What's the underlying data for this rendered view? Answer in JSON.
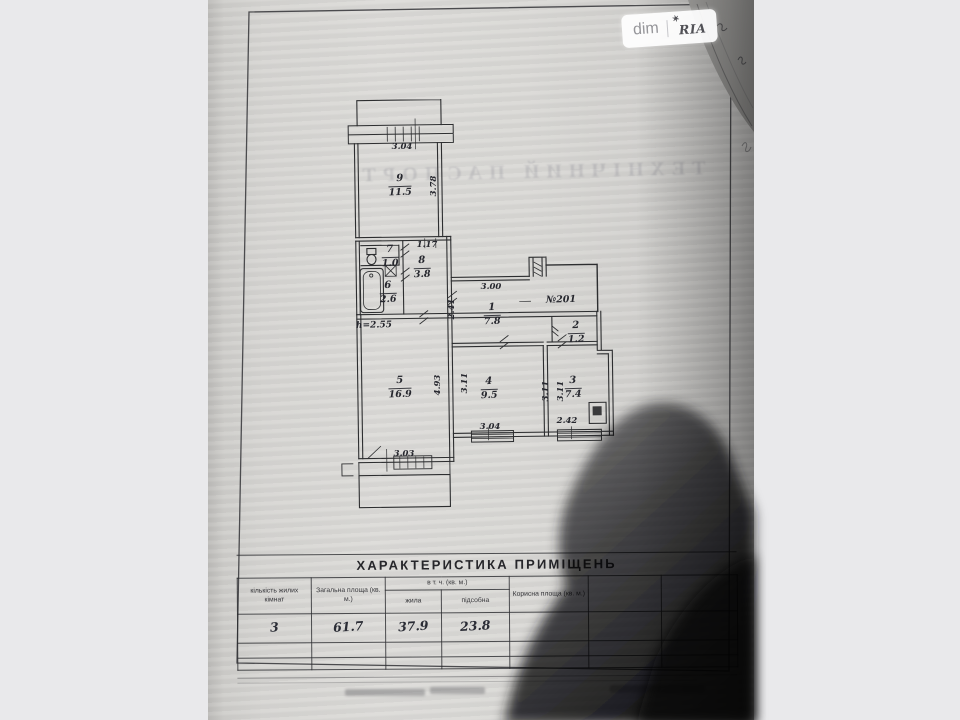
{
  "watermark": {
    "left": "dim",
    "right": "RIA",
    "star": "✶"
  },
  "bleed_text": "ТЕХНІЧНИЙ ПАСПОРТ",
  "colors": {
    "background": "#e9e9eb",
    "paper": "#d8d7d4",
    "ink": "#2d2e30",
    "shadow": "#0d0d10"
  },
  "plan": {
    "apartment_number_label": "№201",
    "height_note": "h=2.55",
    "rooms": [
      {
        "num": "9",
        "area": "11.5",
        "x": 400,
        "y": 174
      },
      {
        "num": "7",
        "area": "1.0",
        "x": 390,
        "y": 245
      },
      {
        "num": "8",
        "area": "3.8",
        "x": 422,
        "y": 256
      },
      {
        "num": "6",
        "area": "2.6",
        "x": 388,
        "y": 281
      },
      {
        "num": "1",
        "area": "7.8",
        "x": 492,
        "y": 303
      },
      {
        "num": "2",
        "area": "1.2",
        "x": 576,
        "y": 321
      },
      {
        "num": "5",
        "area": "16.9",
        "x": 400,
        "y": 376
      },
      {
        "num": "4",
        "area": "9.5",
        "x": 489,
        "y": 377
      },
      {
        "num": "3",
        "area": "7.4",
        "x": 573,
        "y": 376
      }
    ],
    "dims": [
      {
        "text": "3.04",
        "x": 402,
        "y": 147,
        "rot": 0
      },
      {
        "text": "3.78",
        "x": 434,
        "y": 186,
        "rot": -90
      },
      {
        "text": "1.17",
        "x": 427,
        "y": 245,
        "rot": 0
      },
      {
        "text": "3.00",
        "x": 491,
        "y": 287,
        "rot": 0
      },
      {
        "text": "2.41",
        "x": 452,
        "y": 309,
        "rot": -90
      },
      {
        "text": "3.11",
        "x": 465,
        "y": 383,
        "rot": -90
      },
      {
        "text": "4.93",
        "x": 438,
        "y": 385,
        "rot": -90
      },
      {
        "text": "3.11",
        "x": 546,
        "y": 391,
        "rot": -90
      },
      {
        "text": "3.11",
        "x": 561,
        "y": 391,
        "rot": -90
      },
      {
        "text": "3.04",
        "x": 490,
        "y": 427,
        "rot": 0
      },
      {
        "text": "2.42",
        "x": 567,
        "y": 421,
        "rot": 0
      },
      {
        "text": "3.03",
        "x": 404,
        "y": 454,
        "rot": 0
      }
    ]
  },
  "table": {
    "title": "ХАРАКТЕРИСТИКА ПРИМІЩЕНЬ",
    "headers": {
      "col1": "кількість жилих кімнат",
      "col2": "Загальна площа (кв. м.)",
      "group": "в т. ч. (кв. м.)",
      "col3": "жила",
      "col4": "підсобна",
      "col5": "Корисна площа (кв. м.)"
    },
    "row": {
      "rooms": "3",
      "total": "61.7",
      "living": "37.9",
      "utility": "23.8"
    }
  }
}
